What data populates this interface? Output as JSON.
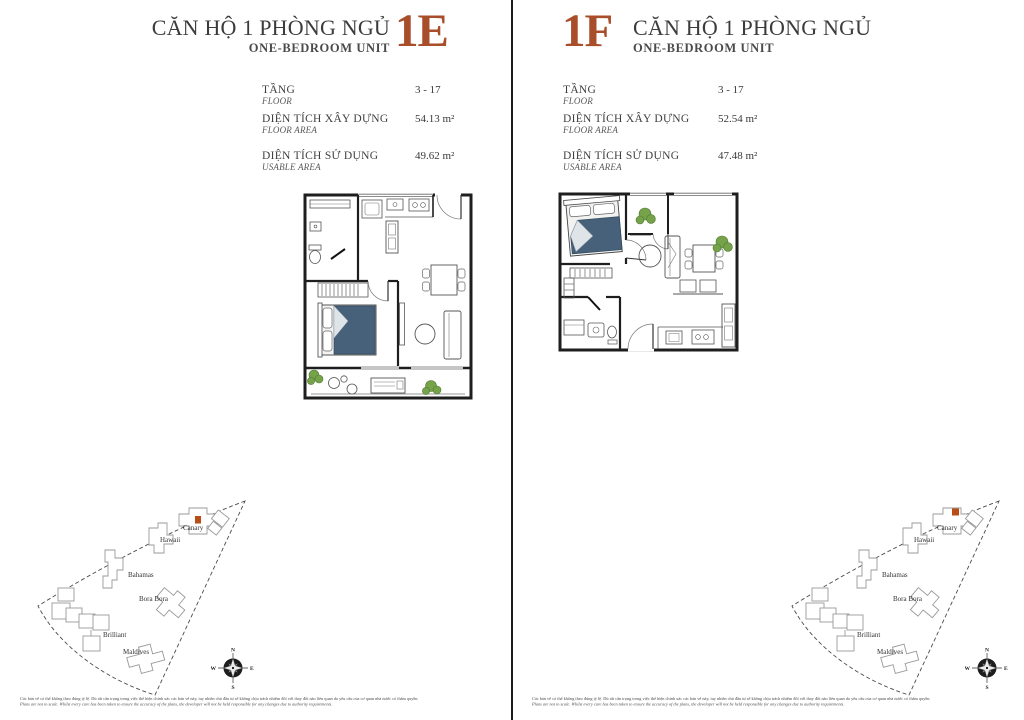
{
  "colors": {
    "accent_unit_code": "#a94e2b",
    "site_highlight": "#b84d15",
    "bed_blue": "#47617a",
    "plant_green": "#76a24a"
  },
  "panels": [
    {
      "unit_code": "1E",
      "title_vi": "CĂN HỘ 1 PHÒNG NGỦ",
      "title_en": "ONE-BEDROOM UNIT",
      "specs": [
        {
          "label_vi": "TẦNG",
          "label_en": "FLOOR",
          "value": "3 - 17"
        },
        {
          "label_vi": "DIỆN TÍCH XÂY DỰNG",
          "label_en": "FLOOR AREA",
          "value": "54.13 m²"
        },
        {
          "label_vi": "DIỆN TÍCH SỬ DỤNG",
          "label_en": "USABLE AREA",
          "value": "49.62 m²"
        }
      ]
    },
    {
      "unit_code": "1F",
      "title_vi": "CĂN HỘ 1 PHÒNG NGỦ",
      "title_en": "ONE-BEDROOM UNIT",
      "specs": [
        {
          "label_vi": "TẦNG",
          "label_en": "FLOOR",
          "value": "3 - 17"
        },
        {
          "label_vi": "DIỆN TÍCH XÂY DỰNG",
          "label_en": "FLOOR AREA",
          "value": "52.54 m²"
        },
        {
          "label_vi": "DIỆN TÍCH SỬ DỤNG",
          "label_en": "USABLE AREA",
          "value": "47.48 m²"
        }
      ]
    }
  ],
  "site_map": {
    "labels": {
      "canary": "Canary",
      "hawaii": "Hawaii",
      "bahamas": "Bahamas",
      "bora_bora": "Bora Bora",
      "brilliant": "Brilliant",
      "maldives": "Maldives"
    },
    "highlight_building": "Canary"
  },
  "compass": {
    "n": "N",
    "e": "E",
    "s": "S",
    "w": "W"
  },
  "disclaimer": {
    "vi": "Các bản vẽ có thể không theo đúng tỷ lệ. Dù rất cẩn trọng trong việc thể hiện chính xác các bản vẽ này, tuy nhiên chủ đầu tư sẽ không chịu trách nhiệm đối với thay đổi nào liên quan do yêu cầu của cơ quan nhà nước có thẩm quyền.",
    "en": "Plans are not to scale. Whilst every care has been taken to ensure the accuracy of the plans, the developer will not be held responsible for any changes due to authority requirements."
  }
}
